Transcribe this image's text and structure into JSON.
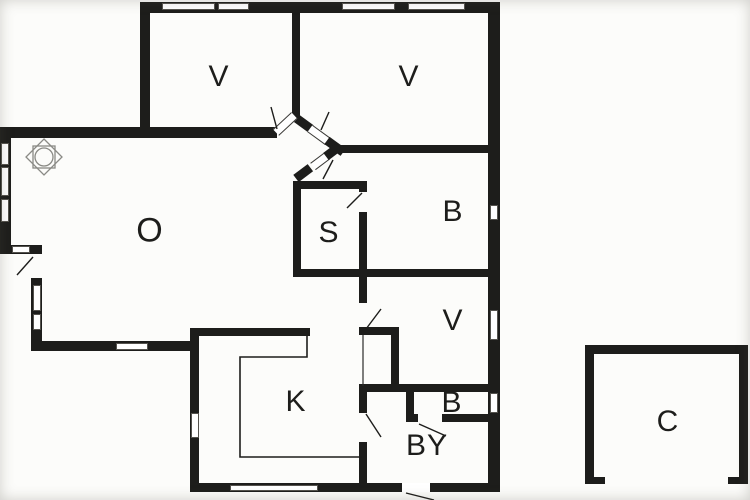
{
  "page": {
    "background_color": "#fcfcfa",
    "wall_color": "#1d1d1b",
    "thin_line_color": "#2a2a28",
    "symbol_line_color": "#8a8a85"
  },
  "floorplan": {
    "description_visible_text_only": true,
    "rooms": [
      {
        "id": "v1",
        "label": "V"
      },
      {
        "id": "v2",
        "label": "V"
      },
      {
        "id": "b1",
        "label": "B"
      },
      {
        "id": "s",
        "label": "S"
      },
      {
        "id": "o",
        "label": "O"
      },
      {
        "id": "v3",
        "label": "V"
      },
      {
        "id": "b2",
        "label": "B"
      },
      {
        "id": "by",
        "label": "BY"
      },
      {
        "id": "k",
        "label": "K"
      },
      {
        "id": "c",
        "label": "C"
      }
    ],
    "symbols": [
      {
        "name": "stove-symbol"
      },
      {
        "name": "kitchen-counter-line"
      },
      {
        "name": "door-swing-lines"
      },
      {
        "name": "window-slots"
      }
    ]
  }
}
